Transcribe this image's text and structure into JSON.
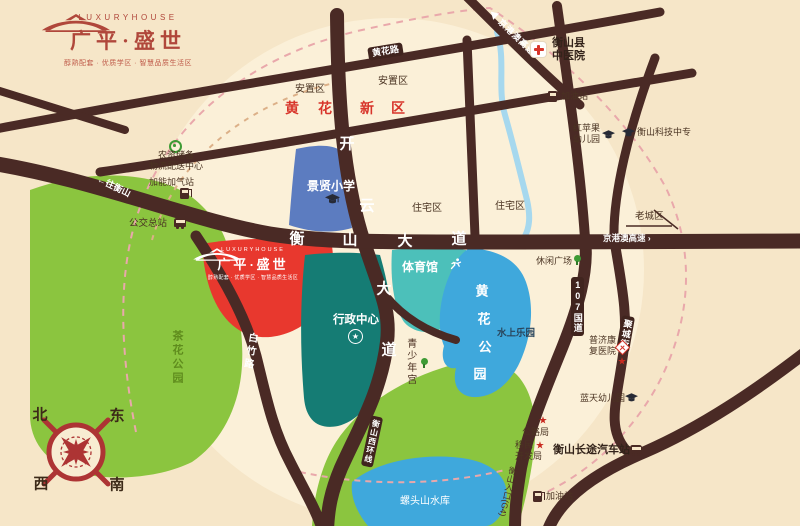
{
  "brand": {
    "name_en": "LUXURYHOUSE",
    "name_cn": "广平·盛世",
    "tagline": "醇熟配套 · 优质学区 · 智慧品质生活区"
  },
  "roads": {
    "hengshan_dadao": {
      "name": "衡山大道",
      "chars": [
        "衡",
        "山",
        "大",
        "道"
      ]
    },
    "kaiyun_dadao": {
      "name": "开云大道",
      "chars": [
        "开",
        "云",
        "大",
        "道"
      ]
    },
    "huanghua_lu": "黄花路",
    "baizhu_lu": "白竹路",
    "g107": "107国道",
    "jucheng_jie": "聚城街",
    "xihuan_xian": "衡山西环线",
    "jinggangao_top": "◀ 京港澳高速",
    "jinggangao_right": "京港澳高速 ›",
    "to_hengshan": "←往衡山",
    "g4_entrance": "衡山入口(G4)"
  },
  "districts": {
    "huanghua_new_area": {
      "name": "黄花新区",
      "chars": [
        "黄",
        "花",
        "新",
        "区"
      ]
    },
    "resettlement_left": "安置区",
    "resettlement_right": "安置区",
    "residential_left": "住宅区",
    "residential_right": "住宅区",
    "old_town": "老城区"
  },
  "areas": {
    "school": "景贤小学",
    "admin_center": "行政中心",
    "stadium": "体育馆",
    "huanghua_park": {
      "name": "黄花公园",
      "chars": [
        "黄",
        "花",
        "公",
        "园"
      ]
    },
    "tea_park": "茶花公园",
    "reservoir": "螺头山水库",
    "water_fun_park": "水上乐园",
    "youth_palace": "青少年宫"
  },
  "pois": {
    "tcm_hospital": {
      "l1": "衡山县",
      "l2": "中医院"
    },
    "gas_station_ne": "加油站",
    "red_apple_kindergarten": {
      "l1": "红苹果",
      "l2": "幼儿园"
    },
    "tech_college": "衡山科技中专",
    "logistics_center": {
      "l1": "农资储备",
      "l2": "物流配送中心"
    },
    "cng_station": "加能加气站",
    "bus_terminal": "公交总站",
    "leisure_plaza": "休闲广场",
    "rehab_hospital": {
      "l1": "普济康",
      "l2": "复医院"
    },
    "blue_sky_kindergarten": "蓝天幼儿园",
    "highway_bureau": "公路局",
    "migration_bureau": {
      "l1": "移民",
      "l2": "开发局"
    },
    "coach_station": "衡山长途汽车站",
    "gas_station_s": "加油站"
  },
  "compass": {
    "north": "北",
    "east": "东",
    "west": "西",
    "south": "南"
  },
  "icons": {
    "star": "★"
  },
  "colors": {
    "background": "#f6e6c8",
    "road": "#4a2a24",
    "brand_red": "#b0473b",
    "site_red": "#e8382e",
    "park_green": "#8bc53f",
    "water_blue": "#3fa8dc",
    "school_blue": "#5c7cc0",
    "admin_teal": "#157c74",
    "stadium_teal": "#4cc0ba",
    "highlight_red": "#d8352b"
  }
}
